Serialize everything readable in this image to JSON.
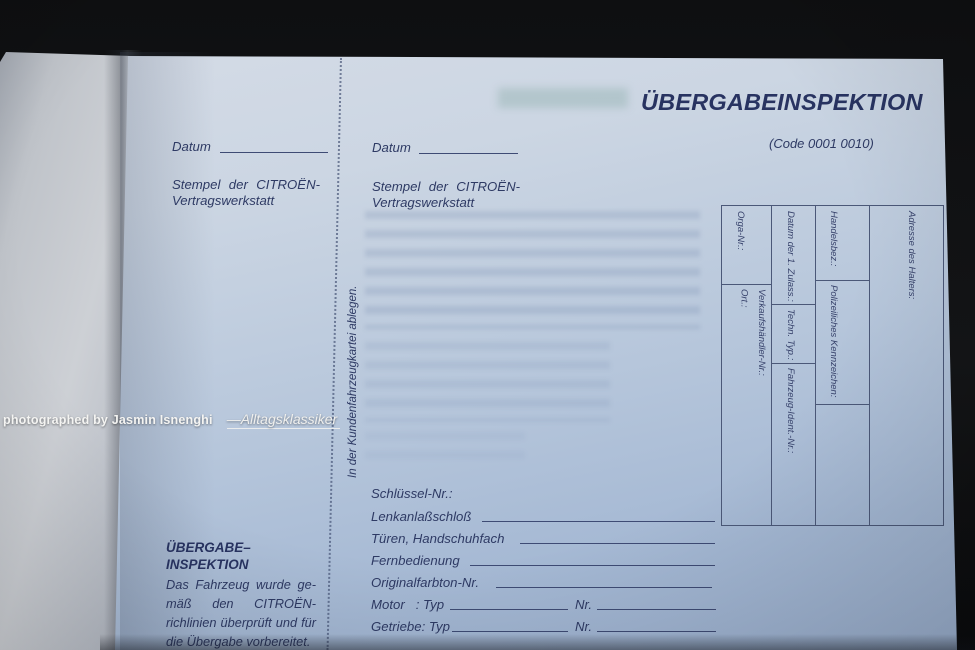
{
  "watermark": {
    "credit": "photographed by Jasmin Isnenghi",
    "brand": "—Alltagsklassiker"
  },
  "form": {
    "title": "ÜBERGABEINSPEKTION",
    "code": "(Code 0001 0010)",
    "left_column": {
      "datum_label": "Datum",
      "stamp_line1": "Stempel der CITROËN-",
      "stamp_line2": "Vertragswerkstatt"
    },
    "center_column": {
      "datum_label": "Datum",
      "stamp_line1": "Stempel der CITROËN-",
      "stamp_line2": "Vertragswerkstatt",
      "filing_note": "In der Kundenfahrzeugkartei ablegen."
    },
    "vehicle_table": {
      "orga_nr": "Orga-Nr.:",
      "verkaufshaendler_nr": "Verkaufshändler-Nr.:",
      "ort": "Ort.:",
      "datum_erste_zulassung": "Datum der 1. Zulass.:",
      "techn_typ": "Techn. Typ.:",
      "fahrzeug_ident_nr": "Fahrzeug-Ident.-Nr.:",
      "handelsbez": "Handelsbez.:",
      "polizeiliches_kennzeichen": "Polizeiliches Kennzeichen:",
      "adresse_des_halters": "Adresse des Halters:"
    },
    "keys_section": {
      "heading": "Schlüssel-Nr.:",
      "rows": [
        "Lenkanlaßschloß",
        "Türen, Handschuhfach",
        "Fernbedienung",
        "Originalfarbton-Nr."
      ],
      "motor_label": "Motor   : Typ",
      "getriebe_label": "Getriebe: Typ",
      "nr_label": "Nr."
    },
    "inspection_note": {
      "heading_line1": "ÜBERGABE–",
      "heading_line2": "INSPEKTION",
      "body_lines": [
        "Das Fahrzeug wurde ge-",
        "mäß den CITROËN-",
        "richlinien überprüft und für",
        "die Übergabe vorbereitet."
      ]
    }
  },
  "colors": {
    "page_blue": "#b6c6db",
    "facing_page_grey": "#c6cace",
    "ink_navy": "#2e3a64",
    "photo_background": "#0e0f11",
    "watermark_white": "#f4f4f2"
  }
}
